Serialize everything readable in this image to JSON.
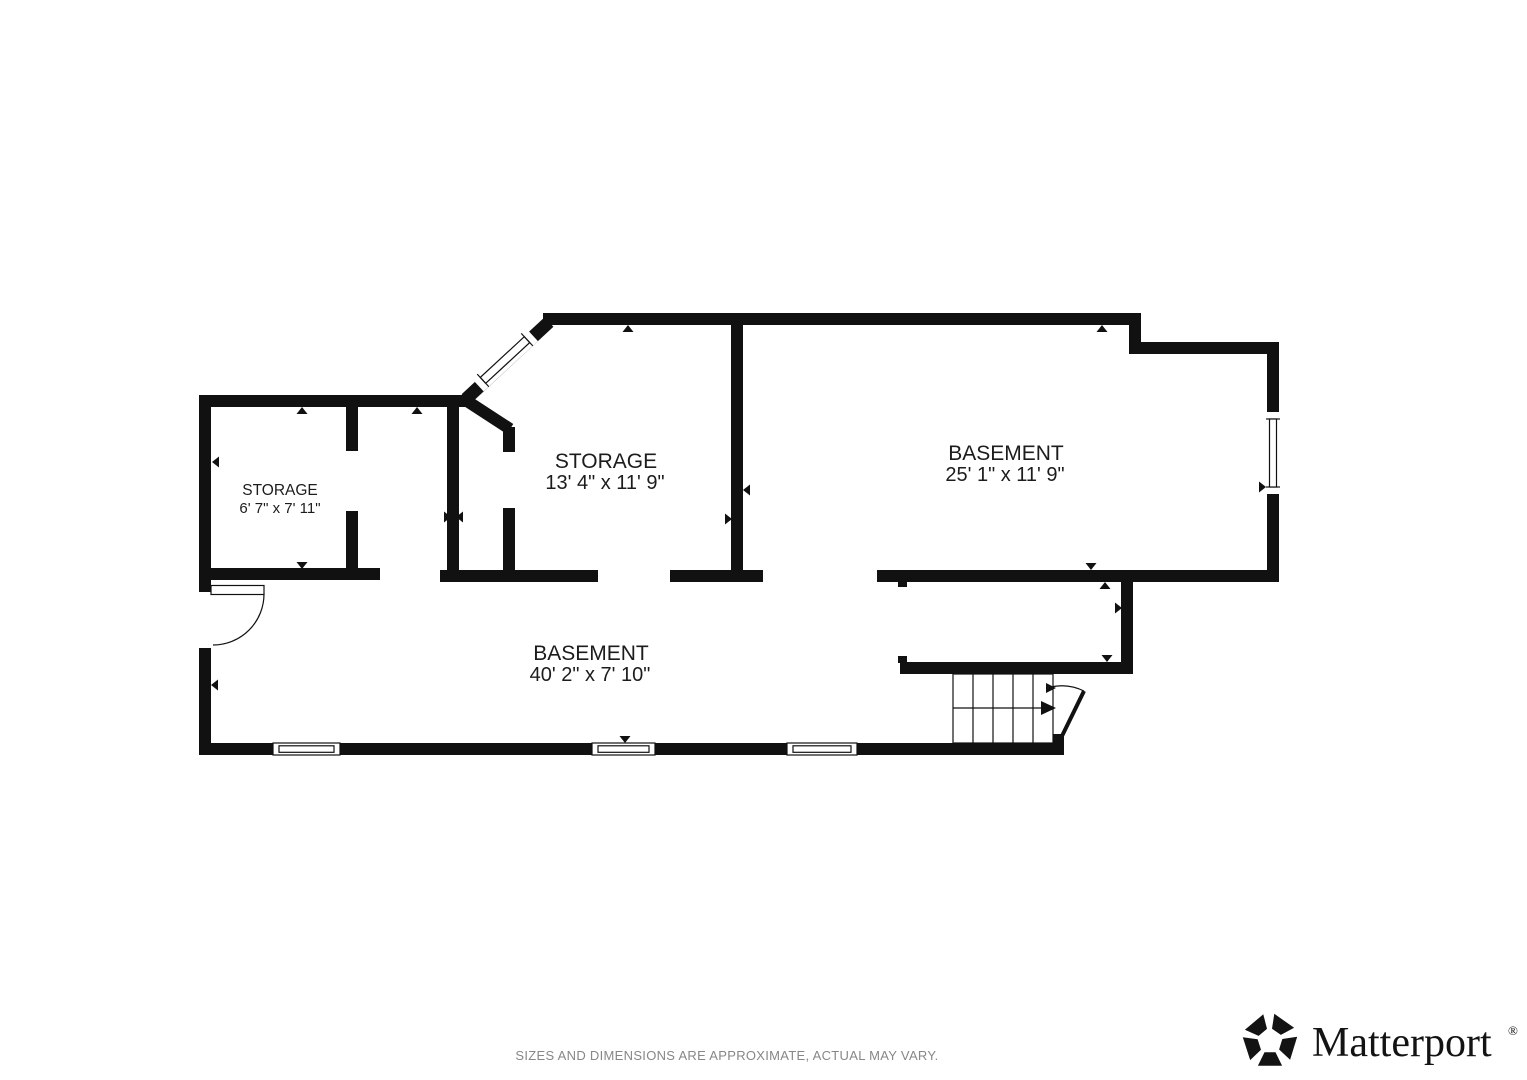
{
  "floorplan": {
    "wall_color": "#111111",
    "label_color": "#1c1c1c",
    "rooms": [
      {
        "id": "storage-small",
        "name": "STORAGE",
        "dims": "6' 7\" x 7' 11\""
      },
      {
        "id": "storage-main",
        "name": "STORAGE",
        "dims": "13' 4\" x 11' 9\""
      },
      {
        "id": "basement-main",
        "name": "BASEMENT",
        "dims": "25' 1\" x 11' 9\""
      },
      {
        "id": "basement-long",
        "name": "BASEMENT",
        "dims": "40' 2\" x 7' 10\""
      }
    ]
  },
  "footer": {
    "disclaimer": "SIZES AND DIMENSIONS ARE APPROXIMATE, ACTUAL MAY VARY.",
    "color": "#878787"
  },
  "logo": {
    "text": "Matterport",
    "registered": "®",
    "color": "#131313"
  }
}
